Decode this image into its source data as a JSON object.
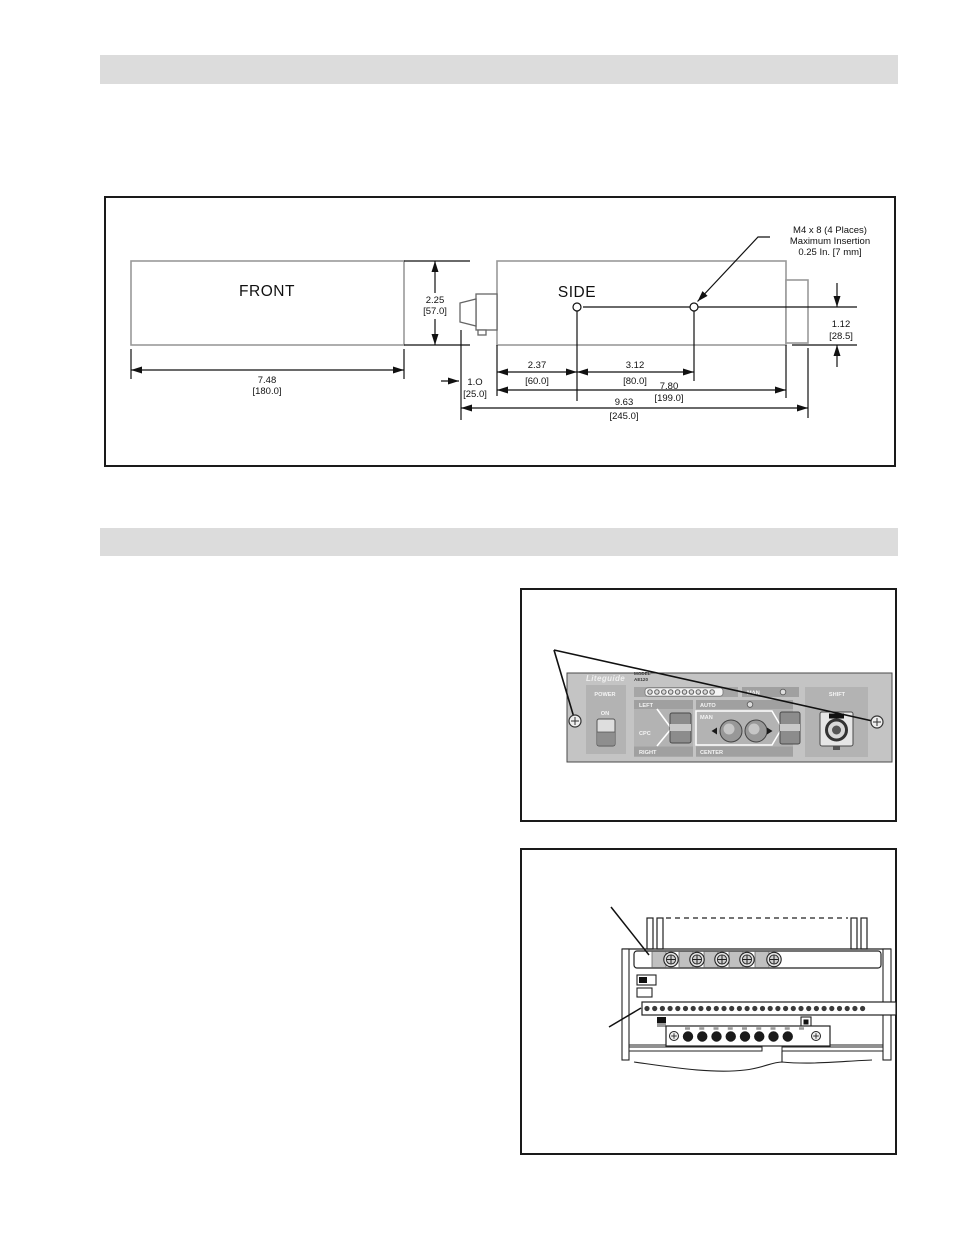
{
  "headers": {
    "first_bar_text": "",
    "second_bar_text": ""
  },
  "dim_figure": {
    "front_label": "FRONT",
    "side_label": "SIDE",
    "callout_line1": "M4 x 8 (4 Places)",
    "callout_line2": "Maximum Insertion",
    "callout_line3": "0.25 In. [7 mm]",
    "front_width_in": "7.48",
    "front_width_mm": "[180.0]",
    "height_in": "2.25",
    "height_mm": "[57.0]",
    "lens_offset_in": "1.O",
    "lens_offset_mm": "[25.0]",
    "hole_offset_in": "2.37",
    "hole_offset_mm": "[60.0]",
    "hole_spacing_in": "3.12",
    "hole_spacing_mm": "[80.0]",
    "body_length_in": "7.80",
    "body_length_mm": "[199.0]",
    "overall_length_in": "9.63",
    "overall_length_mm": "[245.0]",
    "end_height_in": "1.12",
    "end_height_mm": "[28.5]"
  },
  "panel_figure": {
    "brand": "Liteguide",
    "model": "MODEL",
    "model_number": "AE120",
    "power": "POWER",
    "on": "ON",
    "left": "LEFT",
    "cpc": "CPC",
    "right": "RIGHT",
    "man_indicator": "MAN",
    "auto": "AUTO",
    "man": "MAN",
    "center": "CENTER",
    "shift": "SHIFT"
  },
  "colors": {
    "header_bar": "#dcdcdc",
    "panel_base": "#c4c4c4",
    "panel_block": "#b3b3b3",
    "panel_bar": "#a0a0a0",
    "part_outline_gray": "#999999",
    "line_black": "#111111"
  }
}
